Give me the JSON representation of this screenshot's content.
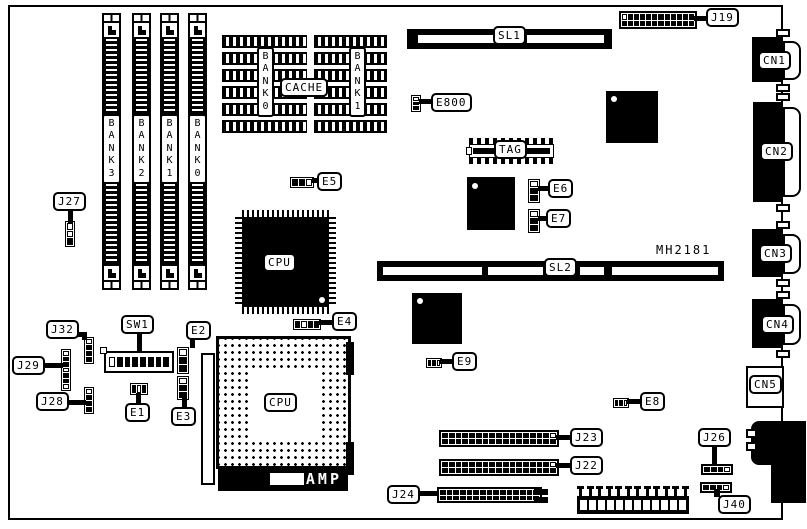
{
  "board": {
    "part_number": "MH2181"
  },
  "slots": {
    "sl1": "SL1",
    "sl2": "SL2"
  },
  "memory_banks": {
    "slot1": "BANK3",
    "slot2": "BANK2",
    "slot3": "BANK1",
    "slot4": "BANK0"
  },
  "cache": {
    "label": "CACHE",
    "bank0": "BANK0",
    "bank1": "BANK1",
    "tag": "TAG"
  },
  "cpu": {
    "qfp_label": "CPU",
    "socket_label": "CPU",
    "socket_brand": "AMP"
  },
  "callouts": {
    "j27": "J27",
    "j19": "J19",
    "e800": "E800",
    "e5": "E5",
    "e6": "E6",
    "e7": "E7",
    "e4": "E4",
    "e9": "E9",
    "e8": "E8",
    "j32": "J32",
    "j29": "J29",
    "j28": "J28",
    "sw1": "SW1",
    "e1": "E1",
    "e2": "E2",
    "e3": "E3",
    "j23": "J23",
    "j22": "J22",
    "j24": "J24",
    "j26": "J26",
    "j40": "J40"
  },
  "rear_connectors": {
    "cn1": "CN1",
    "cn2": "CN2",
    "cn3": "CN3",
    "cn4": "CN4",
    "cn5": "CN5"
  }
}
